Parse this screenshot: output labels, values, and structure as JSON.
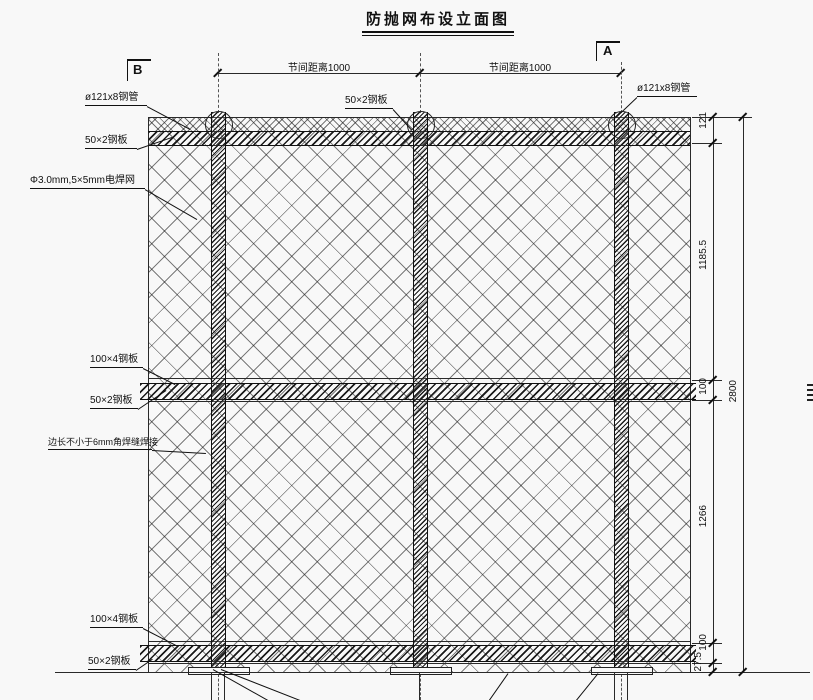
{
  "title": "防抛网布设立面图",
  "section_markers": {
    "left": "B",
    "right": "A"
  },
  "top_dimensions": {
    "left_span": "节间距离1000",
    "right_span": "节间距离1000"
  },
  "callouts": {
    "left": [
      {
        "text": "ø121x8钢管"
      },
      {
        "text": "50×2钢板"
      },
      {
        "text": "Φ3.0mm,5×5mm电焊网"
      },
      {
        "text": "100×4钢板"
      },
      {
        "text": "50×2钢板"
      },
      {
        "text": "边长不小于6mm角焊缝焊接"
      },
      {
        "text": "100×4钢板"
      },
      {
        "text": "50×2钢板"
      }
    ],
    "top_center": {
      "text": "50×2钢板"
    },
    "top_right": {
      "text": "ø121x8钢管"
    }
  },
  "right_dimensions": {
    "segments": [
      "121",
      "1185.5",
      "100",
      "1266",
      "100",
      "27.5"
    ],
    "overall": "2800"
  },
  "colors": {
    "line": "#1a1a1a",
    "background": "#f8f8f8"
  }
}
